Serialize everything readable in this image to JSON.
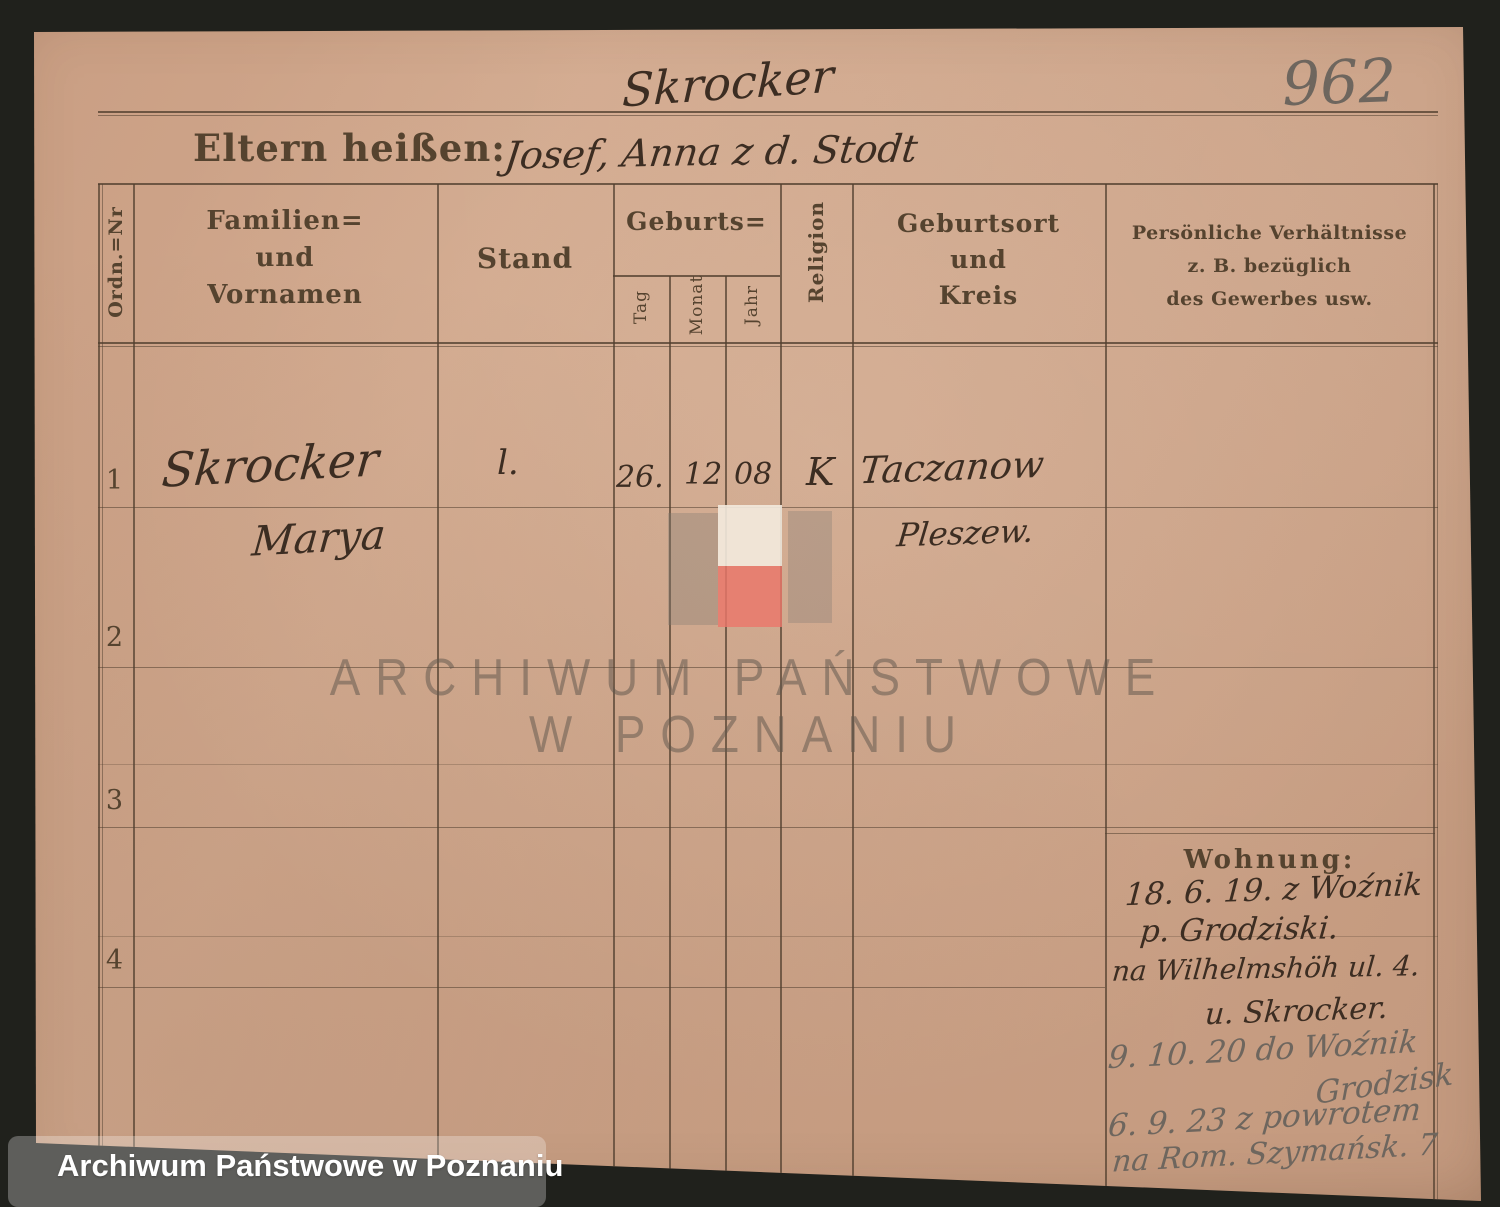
{
  "photo": {
    "archive_number": "962",
    "caption": "Archiwum Państwowe w Poznaniu",
    "watermark": {
      "line1": "ARCHIWUM PAŃSTWOWE",
      "line2": "W POZNANIU"
    }
  },
  "card": {
    "top_surname": "Skrocker",
    "parents_label": "Eltern heißen:",
    "parents_value": "Josef, Anna z d. Stodt",
    "table": {
      "col_ordn": "Ordn.=Nr",
      "col_name_l1": "Familien=",
      "col_name_l2": "und",
      "col_name_l3": "Vornamen",
      "col_stand": "Stand",
      "col_geburts": "Geburts=",
      "col_tag": "Tag",
      "col_monat": "Monat",
      "col_jahr": "Jahr",
      "col_religion": "Religion",
      "col_ort_l1": "Geburtsort",
      "col_ort_l2": "und",
      "col_ort_l3": "Kreis",
      "col_pers_l1": "Persönliche Verhältnisse",
      "col_pers_l2": "z. B. bezüglich",
      "col_pers_l3": "des Gewerbes usw.",
      "rows": [
        {
          "num": "1",
          "surname": "Skrocker",
          "firstname": "Marya",
          "stand": "l.",
          "tag": "26.",
          "monat": "12",
          "jahr": "08",
          "religion": "K",
          "ort": "Taczanow",
          "kreis": "Pleszew."
        },
        {
          "num": "2"
        },
        {
          "num": "3"
        },
        {
          "num": "4"
        }
      ]
    },
    "wohnung": {
      "label": "Wohnung:",
      "ink_lines": [
        "18. 6. 19. z Woźnik",
        "p. Grodziski.",
        "na Wilhelmshöh ul. 4.",
        "u. Skrocker."
      ],
      "pencil_lines": [
        "9. 10. 20 do Woźnik",
        "Grodzisk",
        "6. 9. 23 z powrotem",
        "na Rom. Szymańsk. 7"
      ]
    }
  },
  "colors": {
    "background": "#20211c",
    "paper": "#cba186",
    "print_ink": "#55432f",
    "hand_ink": "#3c2d22",
    "pencil": "#6e665e",
    "overlay_red": "#ea766a",
    "overlay_white": "#f3eade",
    "caption_text": "#ffffff"
  }
}
